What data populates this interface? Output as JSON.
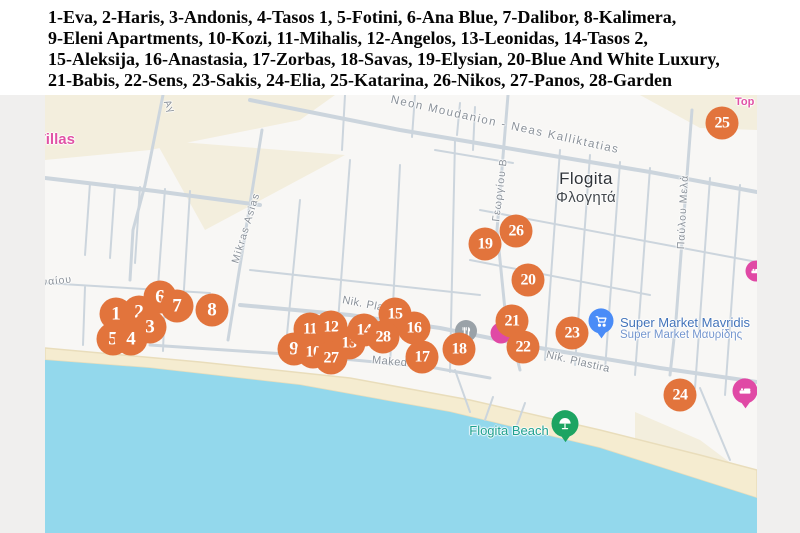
{
  "legend": {
    "lines": [
      "1-Eva, 2-Haris, 3-Andonis, 4-Tasos 1, 5-Fotini, 6-Ana Blue, 7-Dalibor, 8-Kalimera,",
      "9-Eleni Apartments, 10-Kozi, 11-Mihalis, 12-Angelos, 13-Leonidas, 14-Tasos 2,",
      "15-Aleksija, 16-Anastasia, 17-Zorbas, 18-Savas, 19-Elysian, 20-Blue And White Luxury,",
      "21-Babis, 22-Sens, 23-Sakis, 24-Elia, 25-Katarina, 26-Nikos, 27-Panos, 28-Garden"
    ]
  },
  "map": {
    "colors": {
      "marker": "#e2743c",
      "water": "#93d8ec",
      "sand": "#f5ecd0",
      "sand_edge": "#e9ddbb",
      "land": "#f8f7f5",
      "beige": "#f3eedd",
      "road": "#ccd5dd",
      "pin_blue": "#4a8cf7",
      "pin_green": "#1da462",
      "pin_magenta": "#e049a5",
      "poi_gray": "#9aa2a8",
      "label_pink": "#e152a5",
      "label_blue": "#4374ba",
      "label_blue2": "#7496ce",
      "label_teal": "#1fa18f",
      "street": "#8a9199"
    },
    "labels": {
      "villas": "Villas",
      "top": "Top",
      "city_en": "Flogita",
      "city_gr": "Φλογητά",
      "supermarket_en": "Super Market Mavridis",
      "supermarket_gr": "Super Market Μαυρίδης",
      "beach": "Flogita Beach"
    },
    "streets": [
      {
        "text": "Neon Moudanion - Neas Kalliktatias",
        "cx": 460,
        "cy": 30,
        "rot": 12.5,
        "size": 11.5,
        "spacing": 1.5
      },
      {
        "text": "Αγ",
        "cx": 124,
        "cy": 12,
        "rot": 64,
        "size": 10,
        "spacing": 1
      },
      {
        "text": "Mikras Asias",
        "cx": 201,
        "cy": 133,
        "rot": -73,
        "size": 10.5,
        "spacing": 1.2
      },
      {
        "text": "Γεωργίου Β",
        "cx": 455,
        "cy": 95,
        "rot": -83,
        "size": 10.5,
        "spacing": 1
      },
      {
        "text": "Παύλου Μελά",
        "cx": 638,
        "cy": 117,
        "rot": -87,
        "size": 10.5,
        "spacing": 1
      },
      {
        "text": "Nik. Pla",
        "cx": 318,
        "cy": 209,
        "rot": 11,
        "size": 11,
        "spacing": 0.5
      },
      {
        "text": "Nik. Plastira",
        "cx": 533,
        "cy": 267,
        "rot": 13,
        "size": 11,
        "spacing": 0.5
      },
      {
        "text": "Makedo",
        "cx": 348,
        "cy": 267,
        "rot": 5,
        "size": 11,
        "spacing": 0.5
      },
      {
        "text": "ναίου",
        "cx": 12,
        "cy": 186,
        "rot": -6,
        "size": 10.5,
        "spacing": 1
      }
    ],
    "markers": [
      {
        "n": "1",
        "x": 71,
        "y": 219,
        "z": 12
      },
      {
        "n": "2",
        "x": 94,
        "y": 217
      },
      {
        "n": "3",
        "x": 105,
        "y": 232
      },
      {
        "n": "4",
        "x": 86,
        "y": 244,
        "z": 14
      },
      {
        "n": "5",
        "x": 68,
        "y": 244,
        "z": 13
      },
      {
        "n": "6",
        "x": 115,
        "y": 202
      },
      {
        "n": "7",
        "x": 132,
        "y": 211
      },
      {
        "n": "8",
        "x": 167,
        "y": 215
      },
      {
        "n": "9",
        "x": 249,
        "y": 254
      },
      {
        "n": "10",
        "x": 268,
        "y": 257
      },
      {
        "n": "11",
        "x": 265,
        "y": 234
      },
      {
        "n": "12",
        "x": 286,
        "y": 232
      },
      {
        "n": "13",
        "x": 304,
        "y": 248
      },
      {
        "n": "14",
        "x": 319,
        "y": 235
      },
      {
        "n": "15",
        "x": 350,
        "y": 219
      },
      {
        "n": "16",
        "x": 369,
        "y": 233
      },
      {
        "n": "17",
        "x": 377,
        "y": 262
      },
      {
        "n": "18",
        "x": 414,
        "y": 254
      },
      {
        "n": "19",
        "x": 440,
        "y": 149
      },
      {
        "n": "20",
        "x": 483,
        "y": 185
      },
      {
        "n": "21",
        "x": 467,
        "y": 226
      },
      {
        "n": "22",
        "x": 478,
        "y": 252
      },
      {
        "n": "23",
        "x": 527,
        "y": 238
      },
      {
        "n": "24",
        "x": 635,
        "y": 300
      },
      {
        "n": "25",
        "x": 677,
        "y": 28
      },
      {
        "n": "26",
        "x": 471,
        "y": 136
      },
      {
        "n": "27",
        "x": 286,
        "y": 263
      },
      {
        "n": "28",
        "x": 338,
        "y": 242
      }
    ]
  }
}
